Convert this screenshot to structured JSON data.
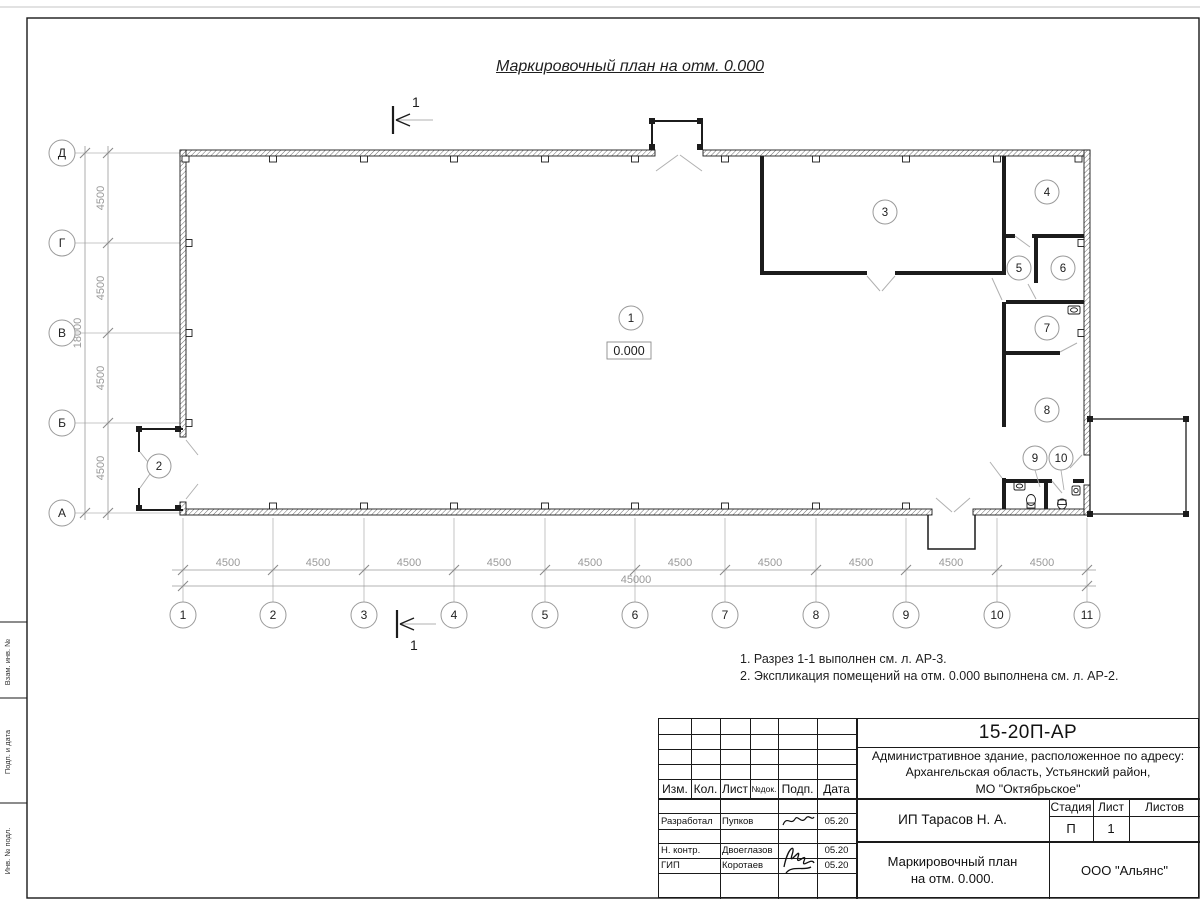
{
  "drawing": {
    "title": "Маркировочный план на отм. 0.000",
    "elevation": "0.000",
    "section_label": "1",
    "notes": {
      "line1": "1. Разрез 1-1 выполнен см. л. АР-3.",
      "line2": "2. Экспликация помещений на отм. 0.000 выполнена см. л. АР-2."
    },
    "axes": {
      "cols": [
        "1",
        "2",
        "3",
        "4",
        "5",
        "6",
        "7",
        "8",
        "9",
        "10",
        "11"
      ],
      "rows": [
        "Д",
        "Г",
        "В",
        "Б",
        "А"
      ]
    },
    "dims": {
      "bay": "4500",
      "total_width": "45000",
      "total_height": "18000"
    },
    "rooms": [
      "1",
      "2",
      "3",
      "4",
      "5",
      "6",
      "7",
      "8",
      "9",
      "10"
    ]
  },
  "margin": {
    "label1": "Взам. инв. №",
    "label2": "Подп. и дата",
    "label3": "Инв. № подл."
  },
  "title_block": {
    "doc_code": "15-20П-АР",
    "object_line1": "Административное здание, расположенное по адресу:",
    "object_line2": "Архангельская область, Устьянский район,",
    "object_line3": "МО \"Октябрьское\"",
    "client": "ИП Тарасов Н. А.",
    "drawing_name_line1": "Маркировочный план",
    "drawing_name_line2": "на отм. 0.000.",
    "company": "ООО \"Альянс\"",
    "stage_label": "Стадия",
    "sheet_label": "Лист",
    "sheets_label": "Листов",
    "stage": "П",
    "sheet": "1",
    "cols": {
      "izm": "Изм.",
      "kol": "Кол.",
      "list": "Лист",
      "doc": "№док.",
      "podp": "Подп.",
      "data": "Дата"
    },
    "rows": [
      {
        "role": "Разработал",
        "name": "Пупков",
        "date": "05.20"
      },
      {
        "role": "Н. контр.",
        "name": "Двоеглазов",
        "date": "05.20"
      },
      {
        "role": "ГИП",
        "name": "Коротаев",
        "date": "05.20"
      }
    ]
  }
}
